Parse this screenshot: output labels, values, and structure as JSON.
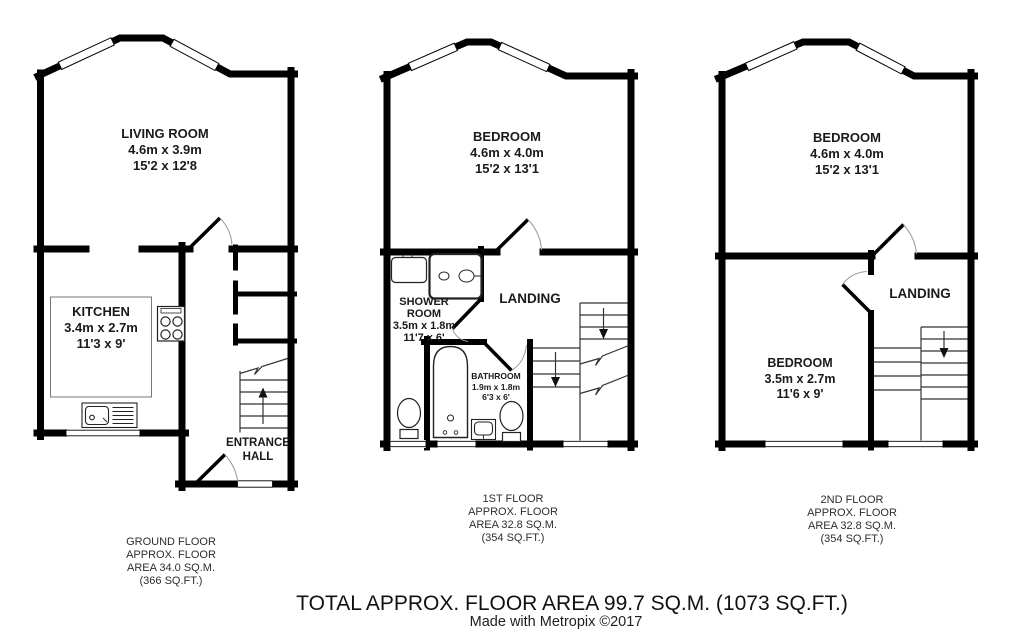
{
  "plans": {
    "ground": {
      "rooms": {
        "living_room": {
          "label": "LIVING ROOM\n4.6m x 3.9m\n15'2 x 12'8"
        },
        "kitchen": {
          "label": "KITCHEN\n3.4m x 2.7m\n11'3 x 9'"
        },
        "entrance_hall": {
          "label": "ENTRANCE\nHALL"
        }
      },
      "caption": "GROUND FLOOR\nAPPROX. FLOOR\nAREA 34.0 SQ.M.\n(366 SQ.FT.)"
    },
    "first": {
      "rooms": {
        "bedroom": {
          "label": "BEDROOM\n4.6m x 4.0m\n15'2 x 13'1"
        },
        "shower_room": {
          "label": "SHOWER\nROOM\n3.5m x 1.8m\n11'7 x 6'"
        },
        "landing": {
          "label": "LANDING"
        },
        "bathroom": {
          "label": "BATHROOM\n1.9m x 1.8m\n6'3 x 6'"
        }
      },
      "caption": "1ST FLOOR\nAPPROX. FLOOR\nAREA 32.8 SQ.M.\n(354 SQ.FT.)"
    },
    "second": {
      "rooms": {
        "bedroom_front": {
          "label": "BEDROOM\n4.6m x 4.0m\n15'2 x 13'1"
        },
        "landing": {
          "label": "LANDING"
        },
        "bedroom_back": {
          "label": "BEDROOM\n3.5m x 2.7m\n11'6 x 9'"
        }
      },
      "caption": "2ND FLOOR\nAPPROX. FLOOR\nAREA 32.8 SQ.M.\n(354 SQ.FT.)"
    }
  },
  "footer": {
    "total": "TOTAL APPROX. FLOOR AREA 99.7 SQ.M. (1073 SQ.FT.)",
    "credit": "Made with Metropix ©2017"
  },
  "colors": {
    "wall": "#000000",
    "fixture": "#222222",
    "stair_line": "#333333",
    "door_arc": "#9a9a9a"
  }
}
